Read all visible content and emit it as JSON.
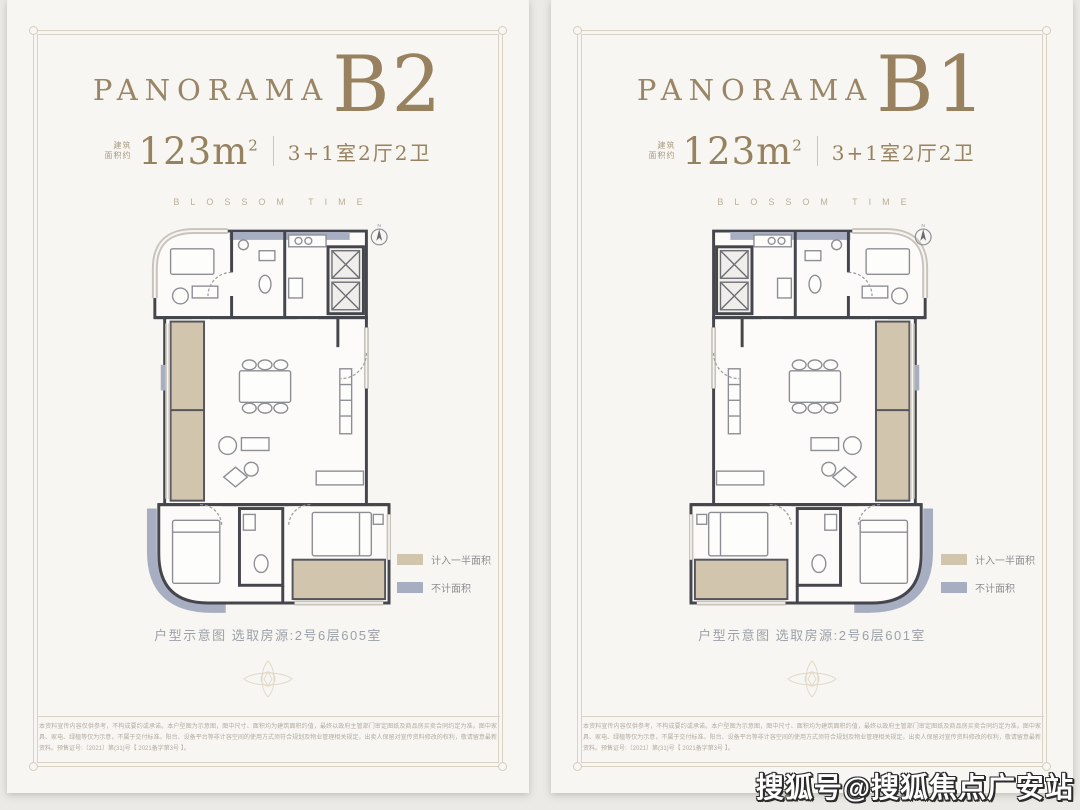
{
  "watermark": "搜狐号@搜狐焦点广安站",
  "colors": {
    "panel_background": "#f8f6f2",
    "page_background": "#eceae6",
    "bronze_accent": "#97815f",
    "frame_line": "#dad3c5",
    "wall": "#45464c",
    "legend_half_area": "#d2c5ae",
    "legend_not_counted": "#a8aec2",
    "caption_gray": "#9ba1a8"
  },
  "panels": [
    {
      "brand": "PANORAMA",
      "unit": "B2",
      "area_label_line1": "建筑",
      "area_label_line2": "面积约",
      "area_value": "123m",
      "area_sup": "2",
      "layout": "3+1室2厅2卫",
      "tagline": "BLOSSOM TIME",
      "legend": [
        {
          "label": "计入一半面积",
          "color": "#d2c5ae"
        },
        {
          "label": "不计面积",
          "color": "#a8aec2"
        }
      ],
      "caption": "户型示意图 选取房源:2号6层605室",
      "disclaimer": "本资料宣传内容仅供参考，不构成要约或承诺。本户型图为示意图，图中尺寸、面积均为建筑面积约值，最终以政府主管部门审定图纸及商品房买卖合同约定为准。图中家具、家电、绿植等仅为示意，不属于交付标准。阳台、设备平台等非计容空间的使用方式须符合规划及物业管理相关规定，出卖人保留对宣传资料修改的权利，敬请留意最新资料。预售证号:〔2021〕第(31)号【 2021备字第3号 】。"
    },
    {
      "brand": "PANORAMA",
      "unit": "B1",
      "area_label_line1": "建筑",
      "area_label_line2": "面积约",
      "area_value": "123m",
      "area_sup": "2",
      "layout": "3+1室2厅2卫",
      "tagline": "BLOSSOM TIME",
      "legend": [
        {
          "label": "计入一半面积",
          "color": "#d2c5ae"
        },
        {
          "label": "不计面积",
          "color": "#a8aec2"
        }
      ],
      "caption": "户型示意图 选取房源:2号6层601室",
      "disclaimer": "本资料宣传内容仅供参考，不构成要约或承诺。本户型图为示意图，图中尺寸、面积均为建筑面积约值，最终以政府主管部门审定图纸及商品房买卖合同约定为准。图中家具、家电、绿植等仅为示意，不属于交付标准。阳台、设备平台等非计容空间的使用方式须符合规划及物业管理相关规定，出卖人保留对宣传资料修改的权利，敬请留意最新资料。预售证号:〔2021〕第(31)号【 2021备字第3号 】。"
    }
  ]
}
